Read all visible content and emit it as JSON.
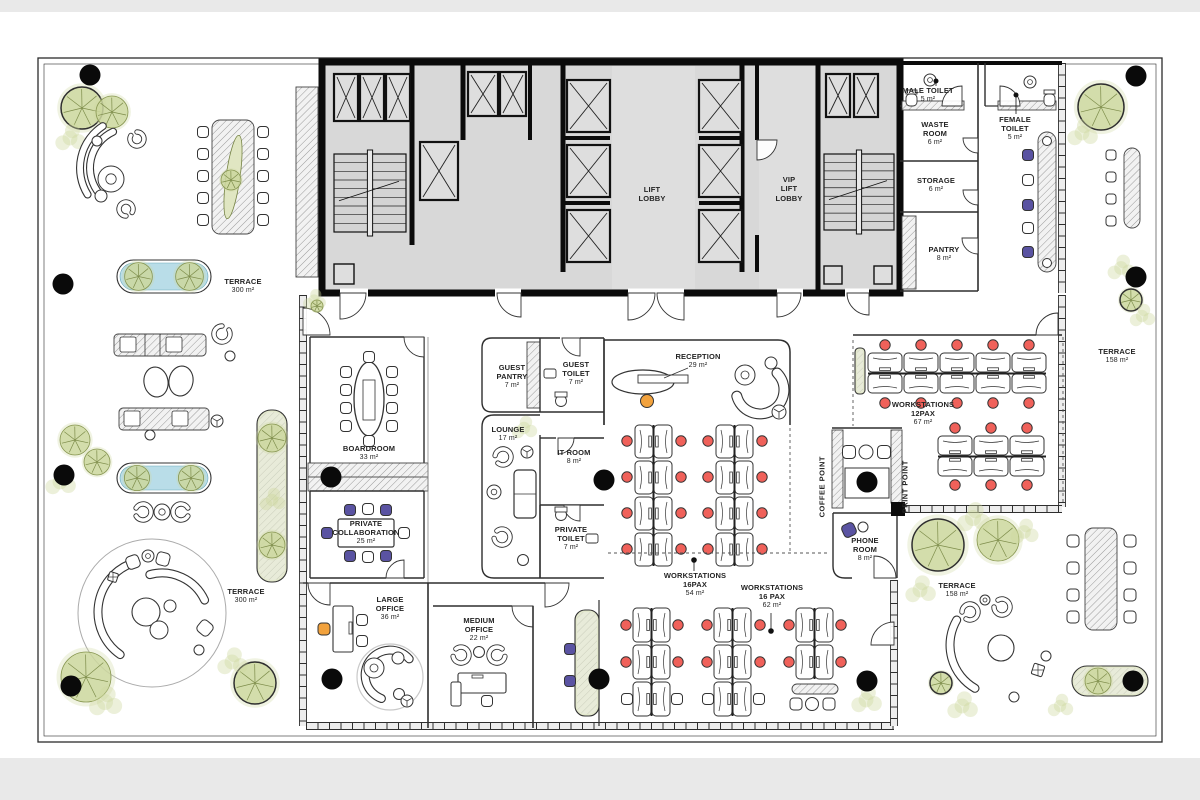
{
  "rooms": {
    "male_toilet": {
      "name": "MALE TOILET",
      "area": "5 m²"
    },
    "waste_room": {
      "name": "WASTE\nROOM",
      "area": "6 m²"
    },
    "storage": {
      "name": "STORAGE",
      "area": "6 m²"
    },
    "pantry": {
      "name": "PANTRY",
      "area": "8 m²"
    },
    "female_toilet": {
      "name": "FEMALE\nTOILET",
      "area": "5 m²"
    },
    "boardroom": {
      "name": "BOARDROOM",
      "area": "33 m²"
    },
    "private_collaboration": {
      "name": "PRIVATE\nCOLLABORATION",
      "area": "25 m²"
    },
    "guest_pantry": {
      "name": "GUEST\nPANTRY",
      "area": "7 m²"
    },
    "guest_toilet": {
      "name": "GUEST\nTOILET",
      "area": "7 m²"
    },
    "lounge": {
      "name": "LOUNGE",
      "area": "17 m²"
    },
    "it_room": {
      "name": "IT ROOM",
      "area": "8 m²"
    },
    "private_toilet": {
      "name": "PRIVATE\nTOILET",
      "area": "7 m²"
    },
    "reception": {
      "name": "RECEPTION",
      "area": "29 m²"
    },
    "workstations_12": {
      "name": "WORKSTATIONS\n12PAX",
      "area": "67 m²"
    },
    "workstations_16a": {
      "name": "WORKSTATIONS\n16PAX",
      "area": "54 m²"
    },
    "workstations_16b": {
      "name": "WORKSTATIONS\n16 PAX",
      "area": "62 m²"
    },
    "large_office": {
      "name": "LARGE\nOFFICE",
      "area": "36 m²"
    },
    "medium_office": {
      "name": "MEDIUM\nOFFICE",
      "area": "22 m²"
    },
    "phone_room": {
      "name": "PHONE\nROOM",
      "area": "8 m²"
    }
  },
  "zones": {
    "lift_lobby": {
      "name": "LIFT\nLOBBY"
    },
    "vip_lift_lobby": {
      "name": "VIP\nLIFT\nLOBBY"
    },
    "coffee_point": {
      "name": "COFFEE POINT"
    },
    "print_point": {
      "name": "PRINT POINT"
    }
  },
  "terraces": {
    "left": {
      "name": "TERRACE",
      "area": "300 m²"
    },
    "right": {
      "name": "TERRACE",
      "area": "158 m²"
    }
  },
  "colors": {
    "chair_red": "#f0615a",
    "chair_purple": "#5a53a2",
    "chair_orange": "#f2a23d",
    "water": "#b9dde8",
    "plant_green": "#ccd79e",
    "plant_dark": "#74833f",
    "core_fill": "#d8d8d8",
    "wall": "#0b0b0b"
  }
}
